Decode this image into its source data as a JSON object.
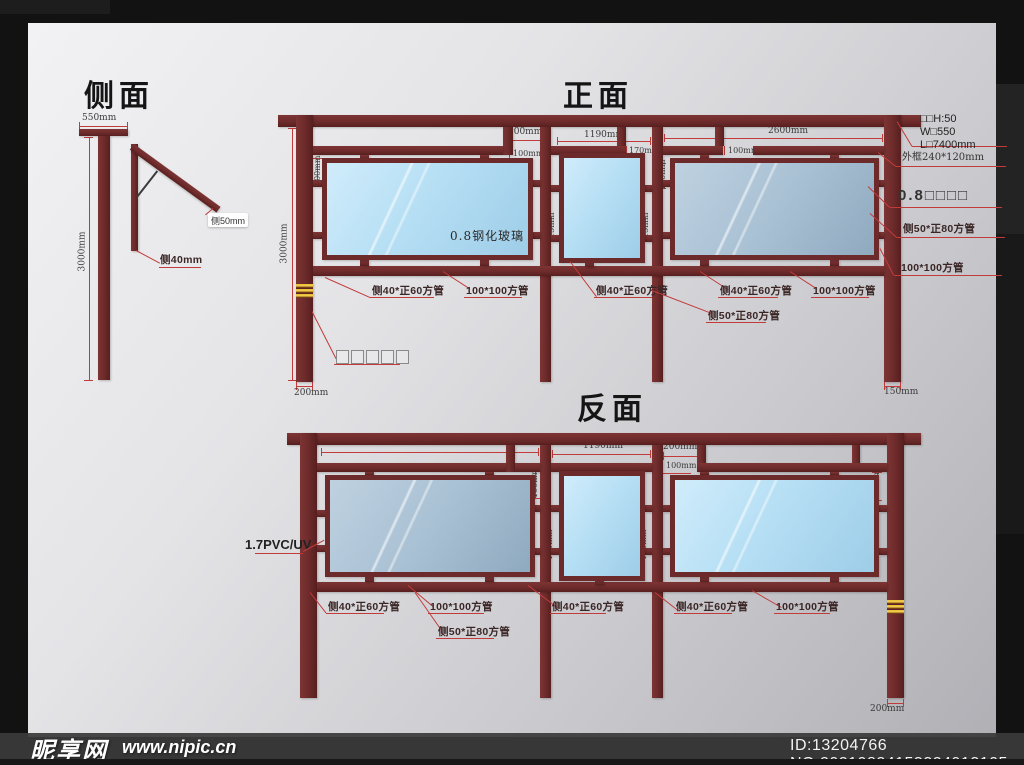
{
  "colors": {
    "structure": "#6e2b2b",
    "glass_blue": "#b6e0f5",
    "glass_gray": "#a9c3d6",
    "dim_red": "#c23b3b",
    "stripe_gold": "#e8b62a"
  },
  "watermark": {
    "site_name": "昵享网",
    "site_url": "www.nipic.cn",
    "id_text": "ID:13204766 NO:20210824153324913105"
  },
  "side": {
    "title": "侧面",
    "dim_width": "550mm",
    "dim_height": "3000mm",
    "tag_50": "侧50mm",
    "tag_40": "侧40mm"
  },
  "front": {
    "title": "正面",
    "dim_gap": "200mm",
    "dim_mid": "1190mm",
    "dim_right": "2600mm",
    "dim_small_1": "100mm",
    "dim_small_2": "170mm",
    "dim_small_3": "100mm",
    "rot_100_left": "100mm",
    "rot_115_left": "115mm",
    "rot_115_right": "115mm",
    "rot_100_right": "100mm",
    "dim_height": "3000mm",
    "dim_foot_left": "200mm",
    "dim_foot_right": "150mm",
    "glass_text": "0.8钢化玻璃",
    "anchor_tag": "□□□□□",
    "tube_labels": [
      "侧40*正60方管",
      "100*100方管",
      "侧40*正60方管",
      "侧40*正60方管",
      "100*100方管"
    ],
    "tube_5080": "侧50*正80方管"
  },
  "back": {
    "title": "反面",
    "dim_left": "2600mm",
    "dim_mid": "1190mm",
    "dim_gap": "200mm",
    "dim_small": "100mm",
    "rot_100_left": "100mm",
    "rot_115_left": "115mm",
    "rot_115_right": "115mm",
    "rot_100_right": "100mm",
    "dim_foot_right": "200mm",
    "pvc_tag": "1.7PVC/UV",
    "tube_labels": [
      "侧40*正60方管",
      "100*100方管",
      "侧40*正60方管",
      "侧40*正60方管",
      "100*100方管"
    ],
    "tube_5080": "侧50*正80方管"
  },
  "notes": {
    "spec_1": "□□H:50",
    "spec_2": "W□550",
    "spec_3": "L□7400mm",
    "frame": "外框240*120mm",
    "glass": "0.8□□□□",
    "tube_5080": "侧50*正80方管",
    "tube_100": "100*100方管"
  }
}
